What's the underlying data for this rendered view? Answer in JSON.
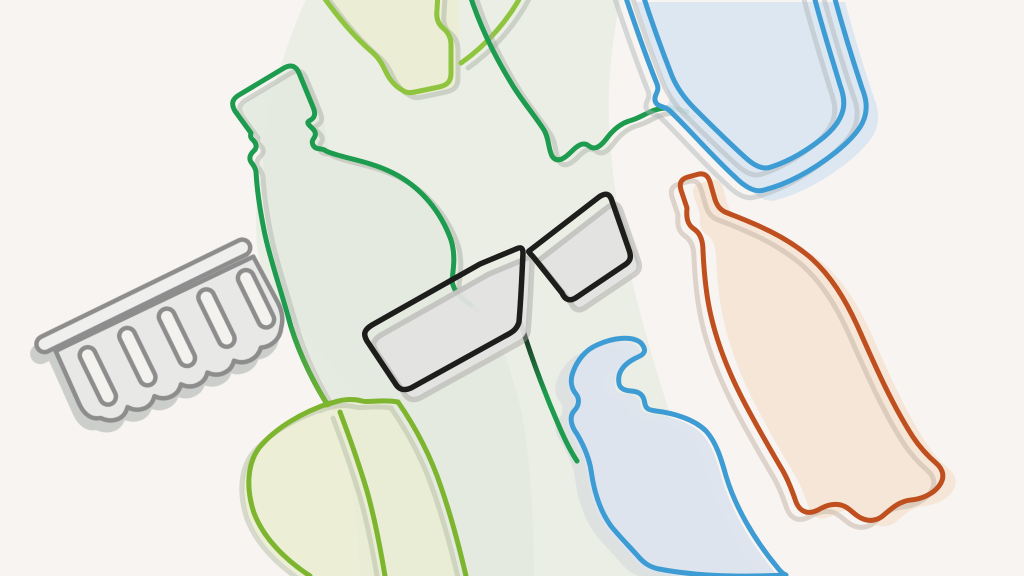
{
  "illustration": {
    "description": "Continuous single-line illustration of plastic packaging items — soda bottles, a water jug, a blister tray, a pump dispenser bottle and containers — with a pair of sunglasses drawn at the center, in pastel offset-fill style",
    "style": "one-line art, offset pastel fills, hard offset echo shadows",
    "background": "#f7f4f1",
    "band": "#e9ece3",
    "objects": [
      {
        "id": "soda-bottle-green",
        "label": "large soda bottle",
        "stroke": "#1d9b4e",
        "fill": "#e4e9df"
      },
      {
        "id": "bottle-lime-top",
        "label": "bottle at top edge",
        "stroke": "#8fc43e",
        "fill": "#eaedd4"
      },
      {
        "id": "connector-line",
        "label": "wavy connecting line",
        "stroke": "#1d9b4e"
      },
      {
        "id": "water-jug-blue",
        "label": "large water jug",
        "stroke": "#3e9cd4",
        "fill": "#d8e5f1"
      },
      {
        "id": "soda-bottle-orange",
        "label": "soda bottle",
        "stroke": "#bf4f1e",
        "fill": "#f4e4d5"
      },
      {
        "id": "blister-tray",
        "label": "blister tray",
        "stroke": "#8d8d8d",
        "fill": "#e8e8e6",
        "slot_fill": "#f4f2ef",
        "bar_fill": "#efefed",
        "slot_count": 5
      },
      {
        "id": "sunglasses",
        "label": "sunglasses",
        "stroke": "#1d1d1b",
        "fill": "#e3e3e1"
      },
      {
        "id": "pump-bottle",
        "label": "pump dispenser bottle",
        "stroke": "#3e9cd4",
        "fill": "#dde4ed",
        "shadow": "#d4dade"
      },
      {
        "id": "container-lime",
        "label": "container bottom",
        "stroke": "#7db52f",
        "fill": "#eaedd4"
      }
    ]
  }
}
